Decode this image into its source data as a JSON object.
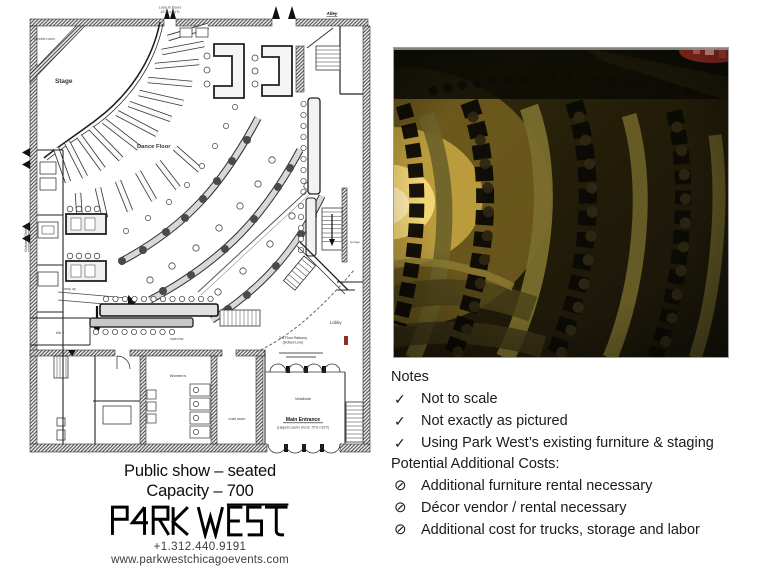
{
  "floor_plan": {
    "labels": {
      "load_in_doors_line1": "Load In Doors",
      "load_in_doors_line2": "42\"w x 81\"h",
      "alley": "Alley",
      "street": "Orleans Street",
      "electric_room": "electric room",
      "stage": "Stage",
      "dance_floor": "Dance Floor",
      "ramp": "ramp up",
      "mix_booth": "Mix 2",
      "main_bar": "main bar",
      "storage": "storage",
      "lobby": "Lobby",
      "balcony_line1": "3rd Floor Balcony",
      "balcony_line2": "(Dotted Line)",
      "womens": "Women's",
      "coat_room": "coat room",
      "vestibule": "Vestibule",
      "main_entrance": "Main Entrance",
      "main_entrance_sub": "(Largest Load In Doors: 72\"w x 81\"h)"
    }
  },
  "photo": {
    "alt": "Park West interior — curved rows of banquette seating with cocktail tables in dim amber light"
  },
  "caption": {
    "line1": "Public show – seated",
    "line2": "Capacity – 700"
  },
  "brand": {
    "name": "PARK WEST",
    "phone": "+1.312.440.9191",
    "website": "www.parkwestchicagoevents.com"
  },
  "notes": {
    "heading": "Notes",
    "check_glyph": "✓",
    "no_glyph": "⊘",
    "check_items": [
      "Not to scale",
      "Not exactly as pictured",
      "Using Park West’s existing furniture & staging"
    ],
    "costs_heading": "Potential Additional Costs:",
    "cost_items": [
      "Additional furniture rental necessary",
      "Décor vendor / rental necessary",
      "Additional cost for trucks, storage and labor"
    ]
  }
}
